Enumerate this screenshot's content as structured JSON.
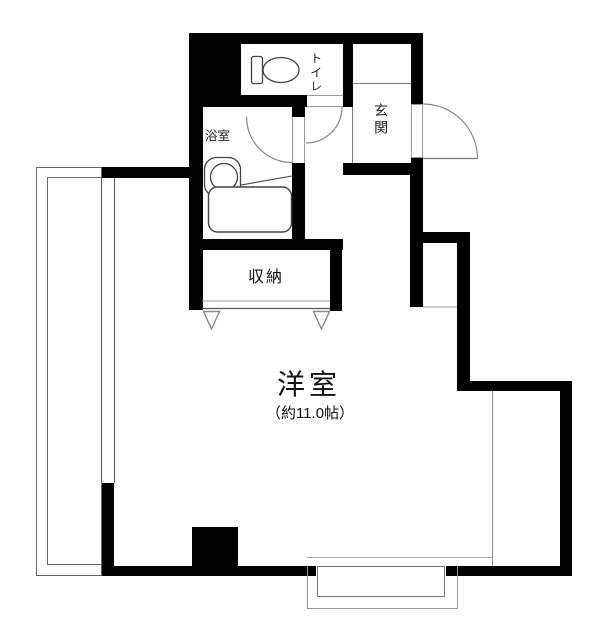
{
  "labels": {
    "western_room": "洋室",
    "western_room_size": "（約11.0帖）",
    "closet": "収納",
    "bathroom": "浴室",
    "toilet": "トイレ",
    "entrance": "玄関"
  },
  "colors": {
    "wall": "#000000",
    "background": "#ffffff",
    "thin_line": "#888888",
    "fixture_stroke": "#444444"
  },
  "icons": {
    "toilet": "toilet-icon",
    "washbasin": "washbasin-icon",
    "bathtub": "bathtub-icon",
    "door_swing": "door-swing-arc",
    "closet_door": "closet-door-triangle"
  }
}
